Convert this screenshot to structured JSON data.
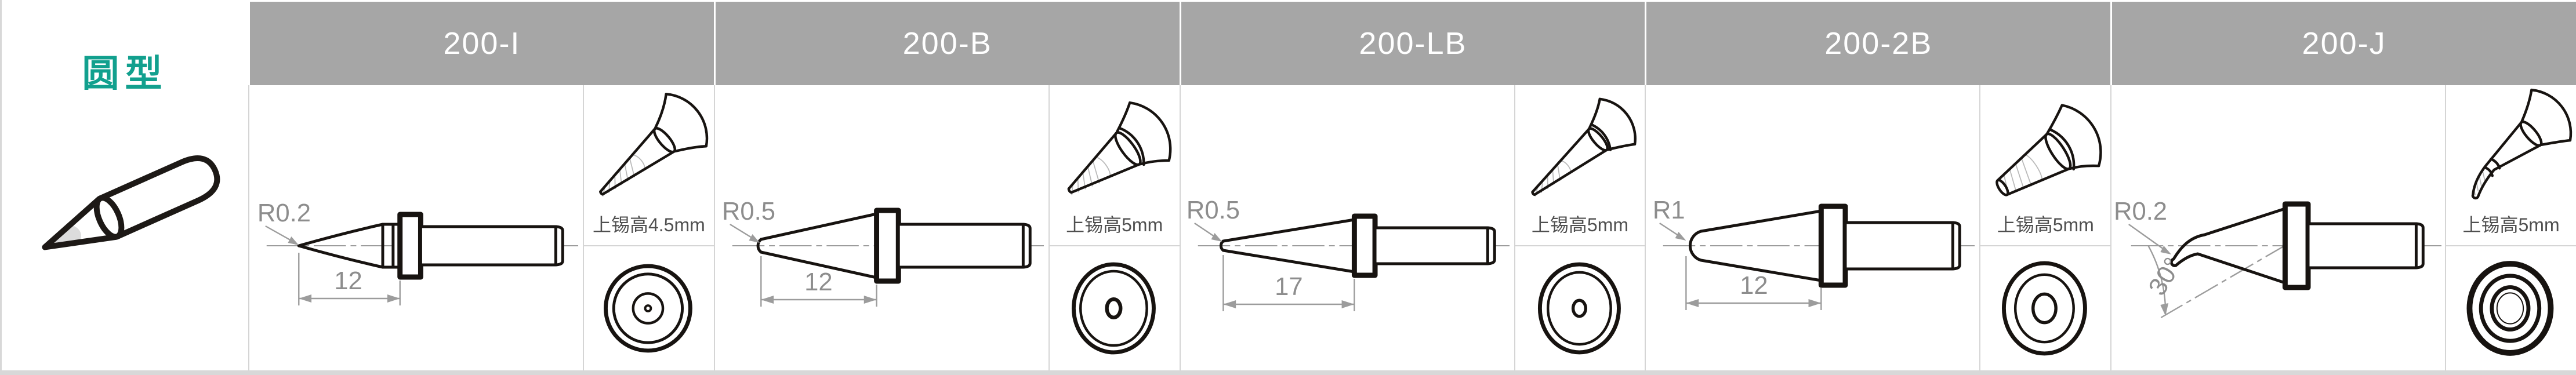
{
  "table": {
    "category_label": "圆型",
    "columns": [
      {
        "model": "200-I",
        "radius_label": "R0.2",
        "length_dim": "12",
        "angle_dim": "",
        "tin_height_label": "上锡高4.5mm"
      },
      {
        "model": "200-B",
        "radius_label": "R0.5",
        "length_dim": "12",
        "angle_dim": "",
        "tin_height_label": "上锡高5mm"
      },
      {
        "model": "200-LB",
        "radius_label": "R0.5",
        "length_dim": "17",
        "angle_dim": "",
        "tin_height_label": "上锡高5mm"
      },
      {
        "model": "200-2B",
        "radius_label": "R1",
        "length_dim": "12",
        "angle_dim": "",
        "tin_height_label": "上锡高5mm"
      },
      {
        "model": "200-J",
        "radius_label": "R0.2",
        "length_dim": "",
        "angle_dim": "30°",
        "tin_height_label": "上锡高5mm"
      }
    ]
  },
  "colors": {
    "category_teal": "#12A08E",
    "header_background": "#A6A6A6",
    "header_text": "#FFFFFF",
    "drawing_line_black": "#171310",
    "dimension_gray": "#8D8D8D",
    "tin_text_gray": "#4F4F4F",
    "cell_divider_gray": "#D5D5D5",
    "bottom_strip_gray": "#D8D8D8"
  }
}
